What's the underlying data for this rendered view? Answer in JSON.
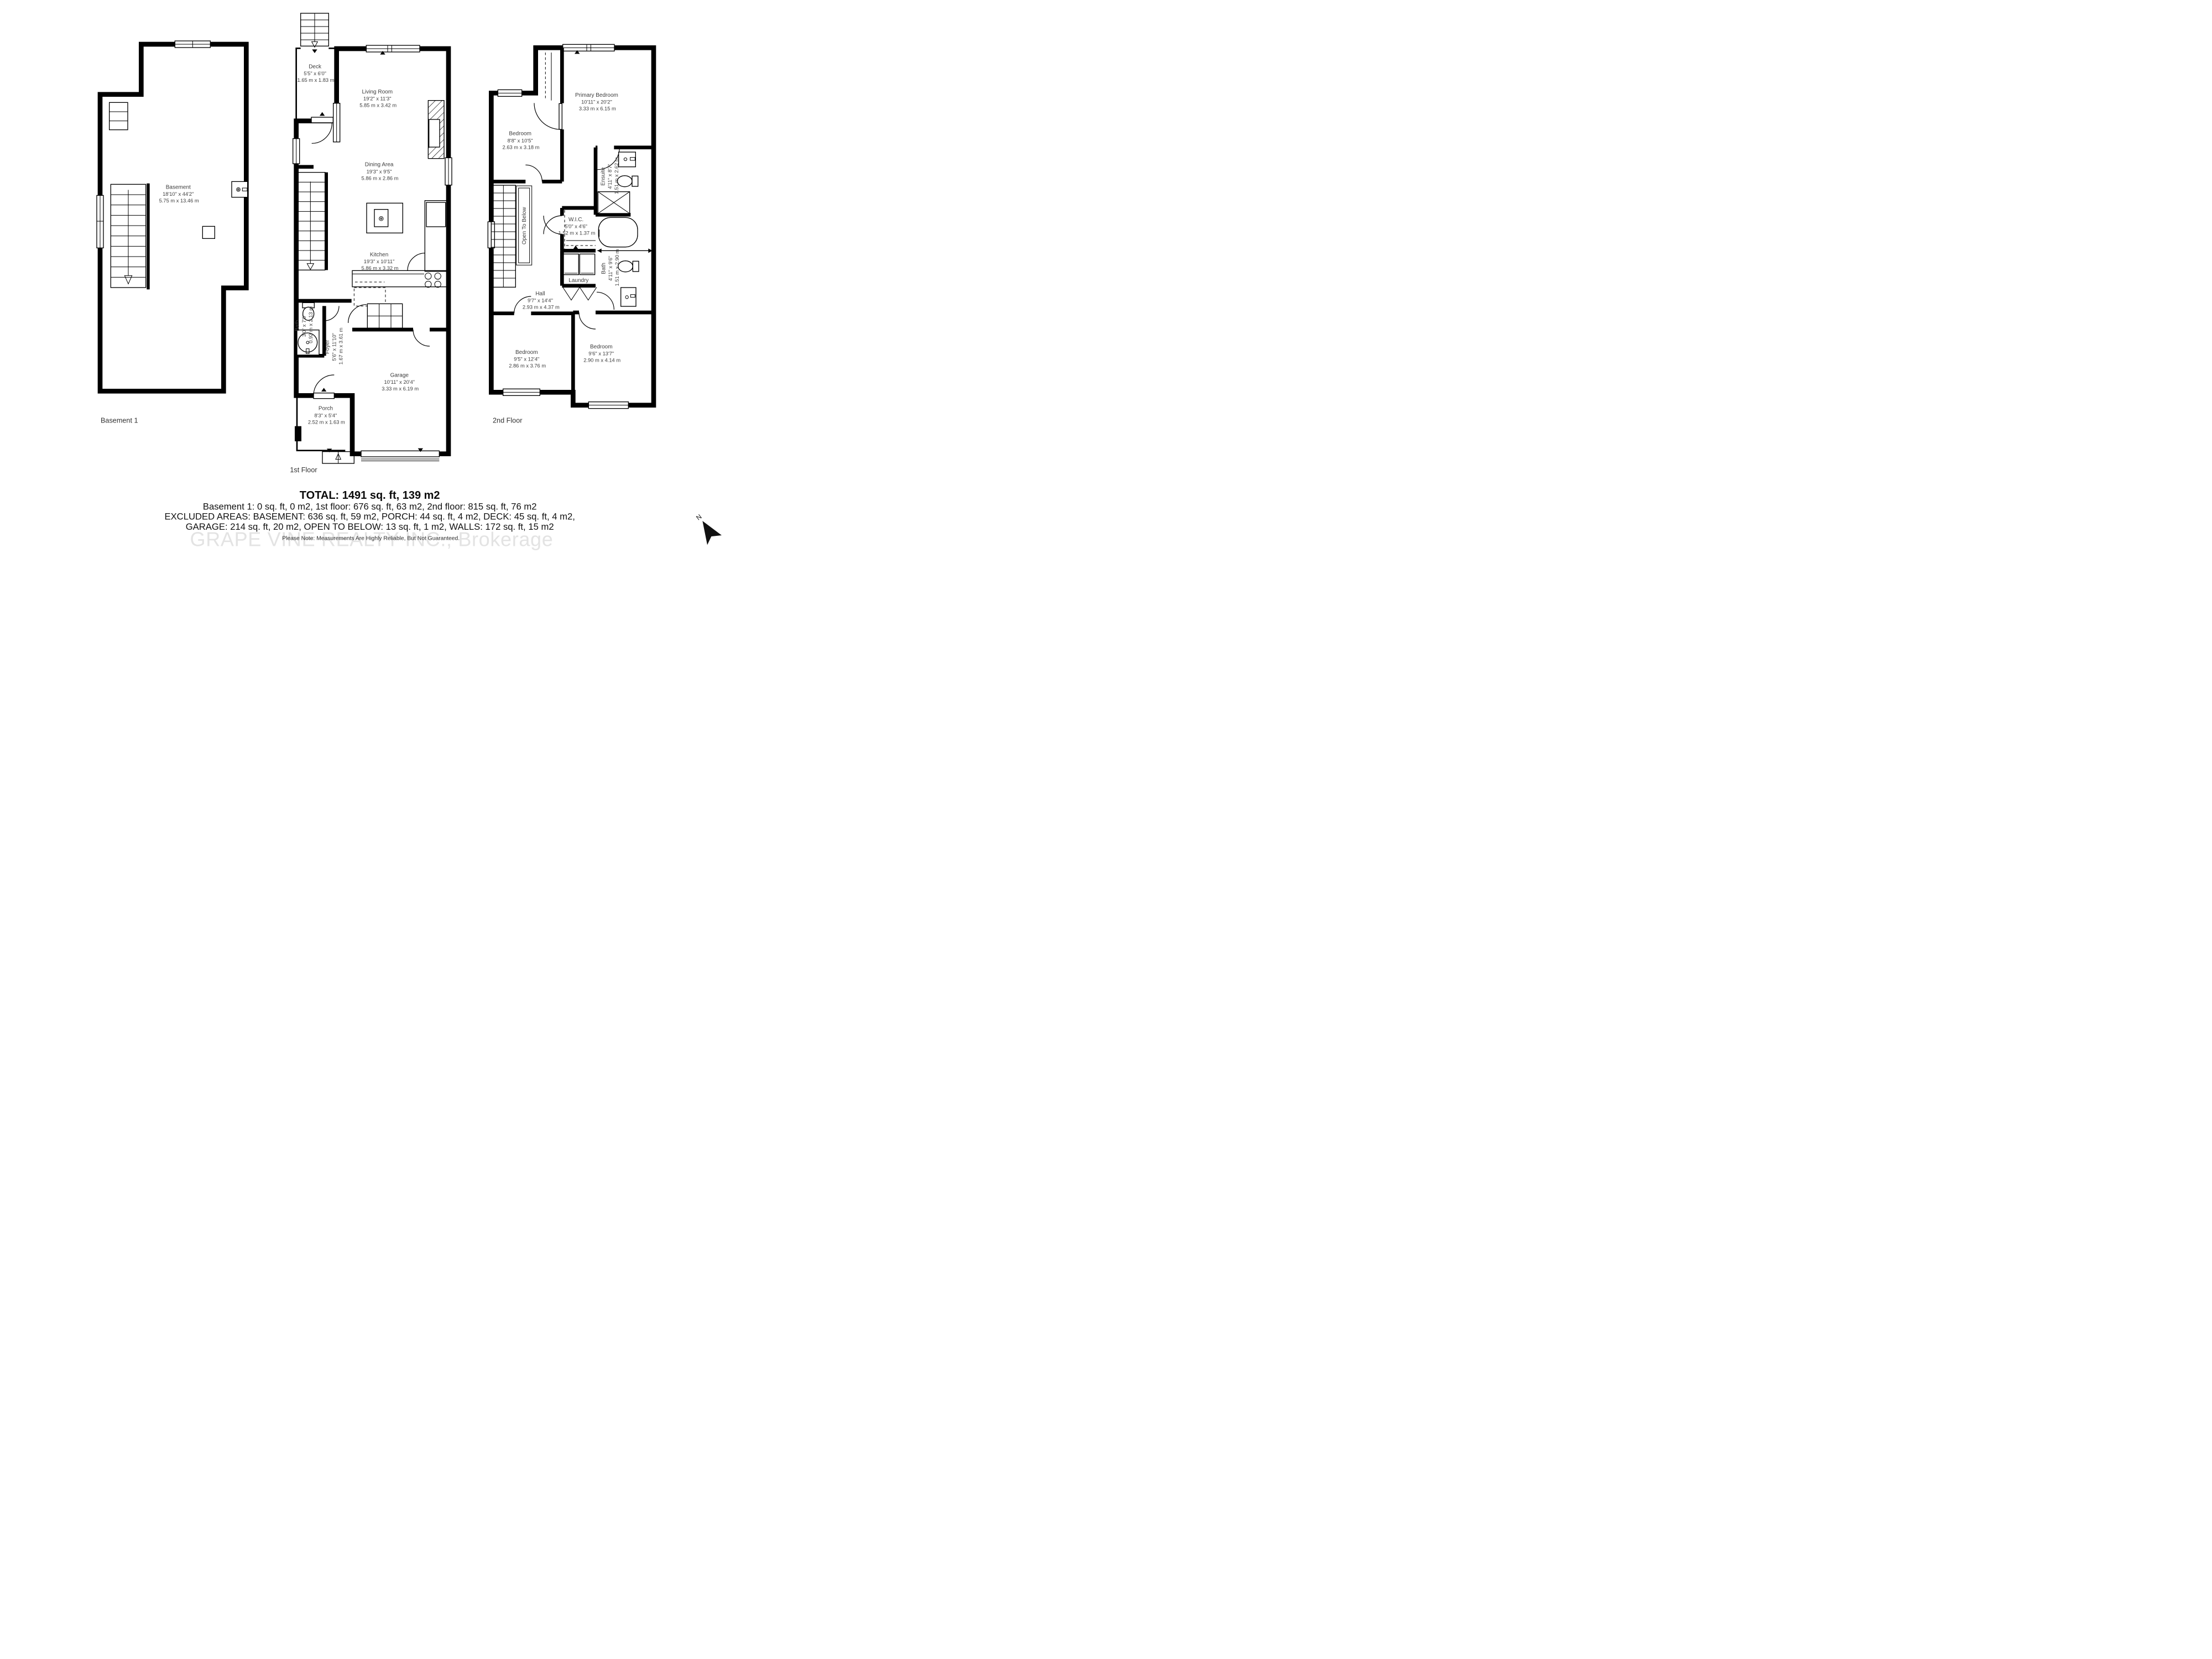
{
  "floors": {
    "basement": {
      "label": "Basement 1",
      "room": {
        "name": "Basement",
        "imperial": "18'10\" x 44'2\"",
        "metric": "5.75 m x 13.46 m"
      }
    },
    "first": {
      "label": "1st Floor",
      "rooms": {
        "deck": {
          "name": "Deck",
          "imperial": "5'5\" x 6'0\"",
          "metric": "1.65 m x 1.83 m"
        },
        "living": {
          "name": "Living Room",
          "imperial": "19'2\" x 11'3\"",
          "metric": "5.85 m x 3.42 m"
        },
        "dining": {
          "name": "Dining Area",
          "imperial": "19'3\" x 9'5\"",
          "metric": "5.86 m x 2.86 m"
        },
        "kitchen": {
          "name": "Kitchen",
          "imperial": "19'3\" x 10'11\"",
          "metric": "5.86 m x 3.32 m"
        },
        "bath": {
          "name": "Bath",
          "imperial": "3'0\" x 7'0\"",
          "metric": "0.92 m x 2.13 m"
        },
        "foyer": {
          "name": "Foyer",
          "imperial": "5'6\" x 11'10\"",
          "metric": "1.67 m x 3.61 m"
        },
        "garage": {
          "name": "Garage",
          "imperial": "10'11\" x 20'4\"",
          "metric": "3.33 m x 6.19 m"
        },
        "porch": {
          "name": "Porch",
          "imperial": "8'3\" x 5'4\"",
          "metric": "2.52 m x 1.63 m"
        }
      }
    },
    "second": {
      "label": "2nd Floor",
      "rooms": {
        "primary": {
          "name": "Primary Bedroom",
          "imperial": "10'11\" x 20'2\"",
          "metric": "3.33 m x 6.15 m"
        },
        "bedroom_a": {
          "name": "Bedroom",
          "imperial": "8'8\" x 10'5\"",
          "metric": "2.63 m x 3.18 m"
        },
        "ensuite": {
          "name": "Ensuite",
          "imperial": "4'11\" x 8'7\"",
          "metric": "1.51 m x 2.62 m"
        },
        "wic": {
          "name": "W.I.C.",
          "imperial": "5'0\" x 4'6\"",
          "metric": "1.52 m x 1.37 m"
        },
        "laundry": {
          "name": "Laundry"
        },
        "bath": {
          "name": "Bath",
          "imperial": "4'11\" x 9'6\"",
          "metric": "1.51 m x 2.90 m"
        },
        "hall": {
          "name": "Hall",
          "imperial": "9'7\" x 14'4\"",
          "metric": "2.93 m x 4.37 m"
        },
        "open_below": {
          "name": "Open To Below"
        },
        "bedroom_b": {
          "name": "Bedroom",
          "imperial": "9'5\" x 12'4\"",
          "metric": "2.86 m x 3.76 m"
        },
        "bedroom_c": {
          "name": "Bedroom",
          "imperial": "9'6\" x 13'7\"",
          "metric": "2.90 m x 4.14 m"
        }
      }
    }
  },
  "summary": {
    "total": "TOTAL: 1491 sq. ft, 139 m2",
    "floors_line": "Basement 1: 0 sq. ft, 0 m2, 1st floor: 676 sq. ft, 63 m2, 2nd floor: 815 sq. ft, 76 m2",
    "excluded_line1": "EXCLUDED AREAS: BASEMENT: 636 sq. ft, 59 m2, PORCH: 44 sq. ft, 4 m2, DECK: 45 sq. ft, 4 m2,",
    "excluded_line2": "GARAGE: 214 sq. ft, 20 m2, OPEN TO BELOW: 13 sq. ft, 1 m2, WALLS: 172 sq. ft, 15 m2",
    "note": "Please Note: Measurements Are Highly Reliable, But Not Guaranteed."
  },
  "watermark": "GRAPE VINE REALTY INC., Brokerage",
  "compass": {
    "label": "N"
  },
  "colors": {
    "wall": "#000000",
    "label_text": "#3d3d3d",
    "summary_text": "#111111",
    "watermark": "#e3e3e3"
  }
}
